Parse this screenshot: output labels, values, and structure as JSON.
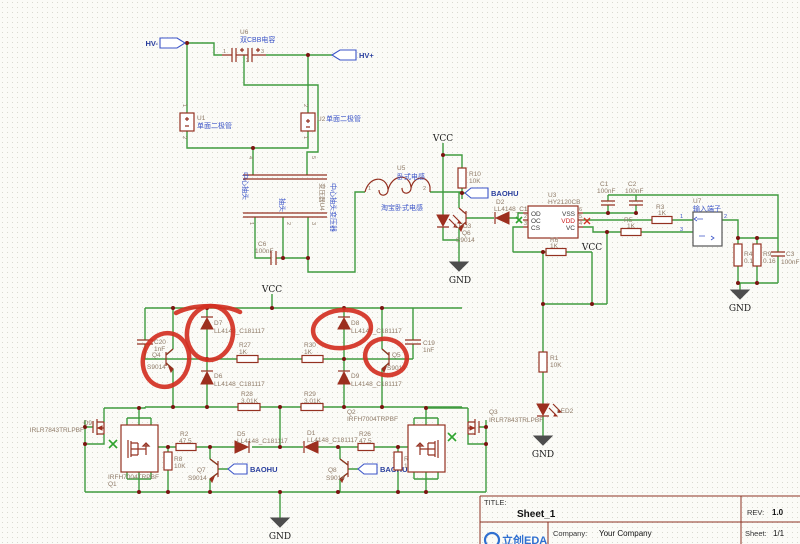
{
  "ports": {
    "hv_minus": "HV-",
    "hv_plus": "HV+",
    "baohu": "BAOHU"
  },
  "power": {
    "vcc": "VCC",
    "gnd": "GND"
  },
  "components": {
    "u6": {
      "ref": "U6",
      "value": "双CBB电容",
      "p1": "1",
      "p2": "2",
      "p3": "3"
    },
    "u1": {
      "ref": "U1",
      "value": "单面二极管",
      "p1": "1",
      "p2": "2"
    },
    "u2": {
      "ref": "U2",
      "value": "单面二极管",
      "p1": "1",
      "p2": "2"
    },
    "u4": {
      "ref": "U4",
      "name": "变压器",
      "value": "中心抽头变压器",
      "tap_label": "中心抽头",
      "tap2_label": "抽头",
      "p1": "1",
      "p2": "2",
      "p3": "3",
      "p4": "4",
      "p5": "5"
    },
    "u5": {
      "ref": "U5",
      "name": "卧式电感",
      "value": "淘宝卧式电感",
      "p1": "1",
      "p2": "2"
    },
    "c6": {
      "ref": "C6",
      "value": "100nF"
    },
    "r10": {
      "ref": "R10",
      "value": "10K"
    },
    "d2": {
      "ref": "D2",
      "value": "LL4148_C181117"
    },
    "led3": {
      "ref": "LED3"
    },
    "q6": {
      "ref": "Q6",
      "value": "S9014"
    },
    "u3": {
      "ref": "U3",
      "value": "HY2120CB",
      "pins_left": [
        {
          "num": "1",
          "name": "OD"
        },
        {
          "num": "2",
          "name": "OC"
        },
        {
          "num": "3",
          "name": "CS"
        }
      ],
      "pins_right": [
        {
          "num": "6",
          "name": "VSS"
        },
        {
          "num": "5",
          "name": "VDD"
        },
        {
          "num": "4",
          "name": "VC"
        }
      ]
    },
    "r6": {
      "ref": "R6",
      "value": "1K"
    },
    "c1": {
      "ref": "C1",
      "value": "100nF"
    },
    "c2": {
      "ref": "C2",
      "value": "100nF"
    },
    "r3": {
      "ref": "R3",
      "value": "1K"
    },
    "r5": {
      "ref": "R5",
      "value": "1K"
    },
    "u7": {
      "ref": "U7",
      "value": "输入端子",
      "p1": "1",
      "p2": "2",
      "p3": "3"
    },
    "r4": {
      "ref": "R4",
      "value": "0.16"
    },
    "r9": {
      "ref": "R9",
      "value": "0.16"
    },
    "c3": {
      "ref": "C3",
      "value": "100nF"
    },
    "r1": {
      "ref": "R1",
      "value": "10K"
    },
    "led2": {
      "ref": "LED2"
    },
    "c20": {
      "ref": "C20",
      "value": "1nF"
    },
    "c19": {
      "ref": "C19",
      "value": "1nF"
    },
    "q4": {
      "ref": "Q4",
      "value": "S9014"
    },
    "q5": {
      "ref": "Q5",
      "value": "S9014"
    },
    "d7": {
      "ref": "D7",
      "value": "LL4148_C181117"
    },
    "d6": {
      "ref": "D6",
      "value": "LL4148_C181117"
    },
    "d8": {
      "ref": "D8",
      "value": "LL4148_C181117"
    },
    "d9": {
      "ref": "D9",
      "value": "LL4148_C181117"
    },
    "r27": {
      "ref": "R27",
      "value": "1K"
    },
    "r30": {
      "ref": "R30",
      "value": "1K"
    },
    "r28": {
      "ref": "R28",
      "value": "3.01K"
    },
    "r29": {
      "ref": "R29",
      "value": "3.01K"
    },
    "q9": {
      "ref": "Q9",
      "value": "IRLR7843TRLPBF"
    },
    "q3": {
      "ref": "Q3",
      "value": "IRLR7843TRLPBF"
    },
    "q1": {
      "ref": "Q1",
      "value": "IRFH7004TRPBF"
    },
    "q2": {
      "ref": "Q2",
      "value": "IRFH7004TRPBF"
    },
    "r2": {
      "ref": "R2",
      "value": "47.5"
    },
    "r26": {
      "ref": "R26",
      "value": "47.5"
    },
    "r8": {
      "ref": "R8",
      "value": "10K"
    },
    "r7": {
      "ref": "R7",
      "value": "10K"
    },
    "q7": {
      "ref": "Q7",
      "value": "S9014"
    },
    "q8": {
      "ref": "Q8",
      "value": "S9014"
    },
    "d5": {
      "ref": "D5",
      "value": "LL4148_C181117"
    },
    "d1": {
      "ref": "D1",
      "value": "LL4148_C181117"
    }
  },
  "title_block": {
    "title_label": "TITLE:",
    "title": "Sheet_1",
    "rev_label": "REV:",
    "rev": "1.0",
    "company_label": "Company:",
    "company": "Your Company",
    "sheet_label": "Sheet:",
    "sheet": "1/1",
    "logo_text": "立创EDA"
  },
  "colors": {
    "wire": "#3f9b3f",
    "symbol": "#943121",
    "annotation_red": "#d23022",
    "net_blue": "#3c55c8"
  }
}
